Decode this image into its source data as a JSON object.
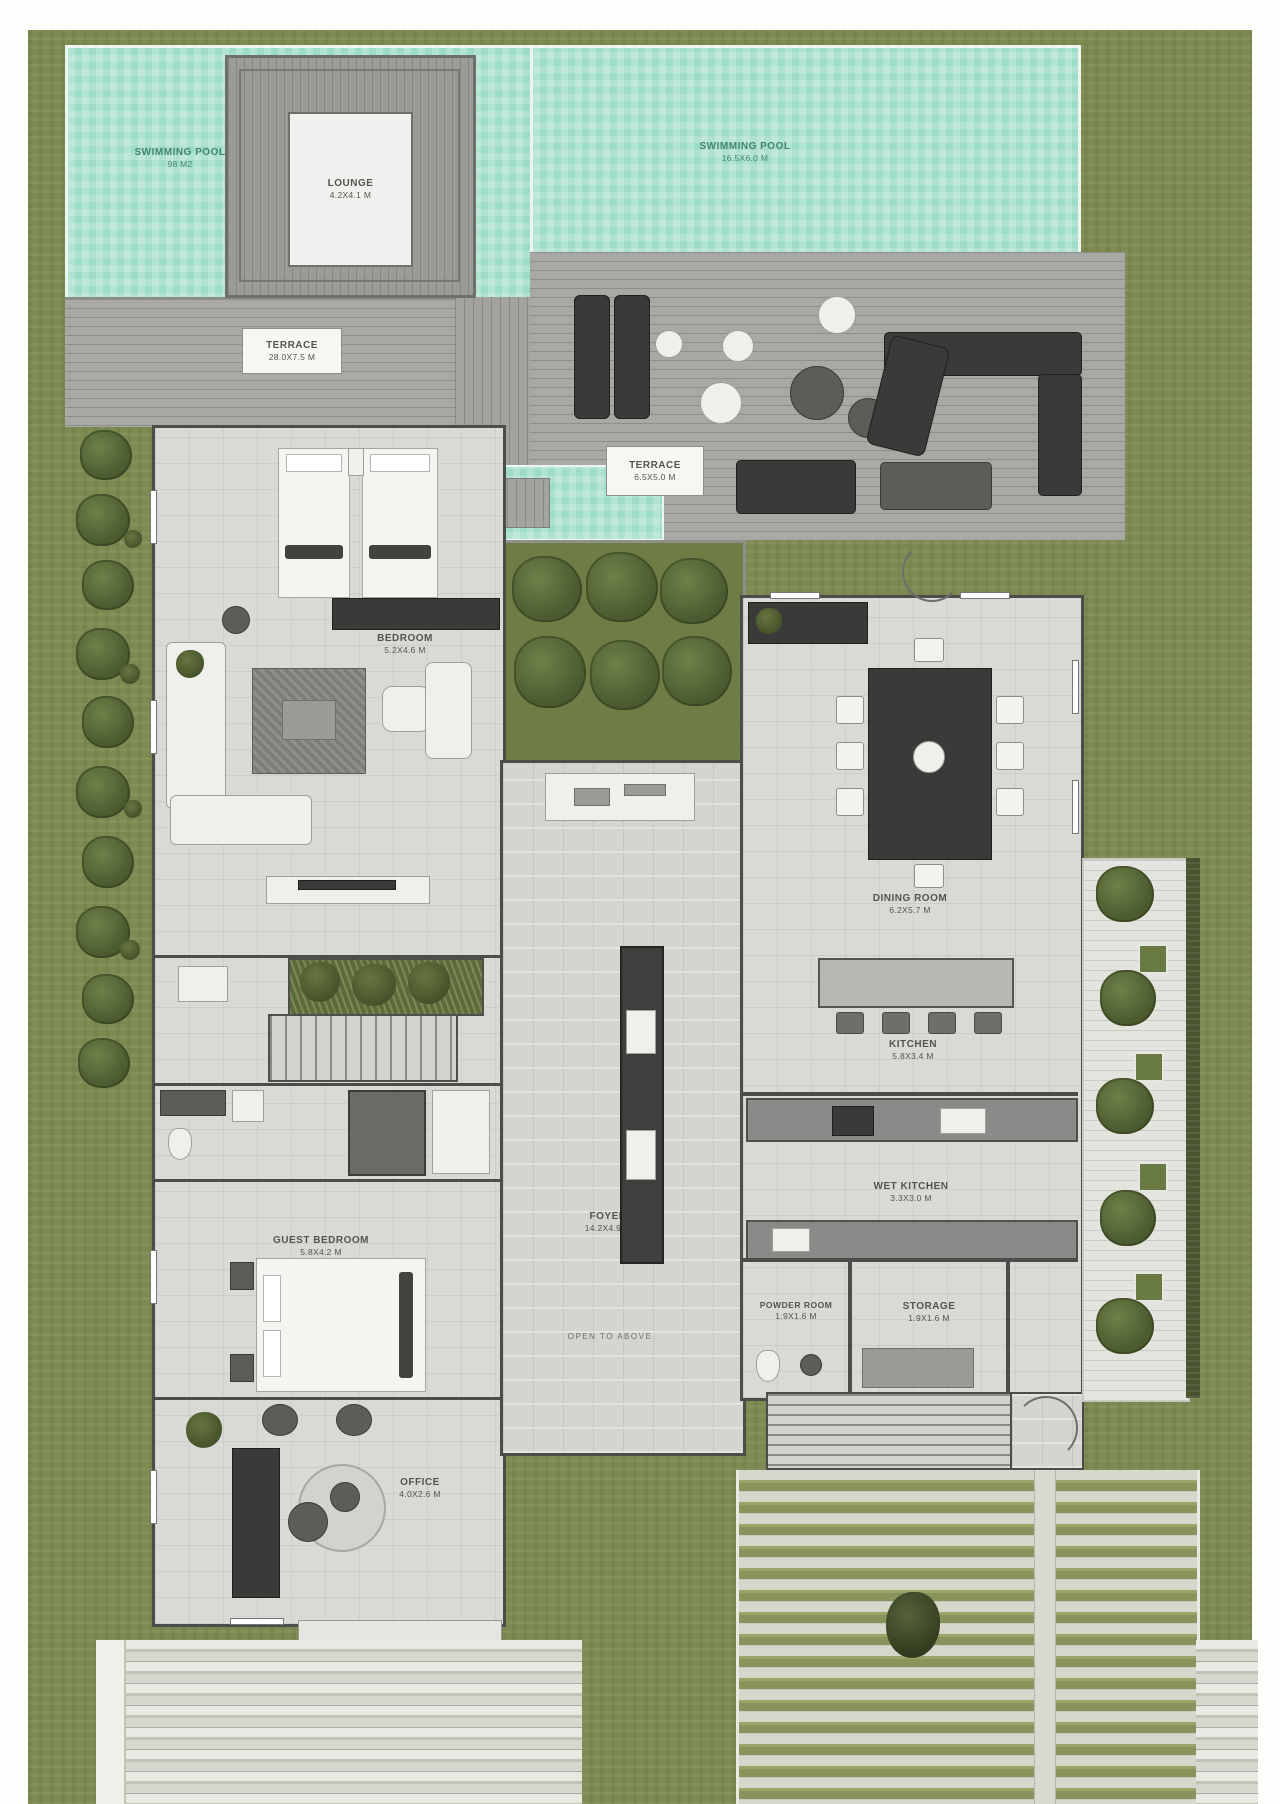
{
  "plan": {
    "pool_left": {
      "label": "SWIMMING POOL",
      "dims": "98 m2"
    },
    "pool_right": {
      "label": "SWIMMING POOL",
      "dims": "16.5x6.0 m"
    },
    "lounge": {
      "label": "LOUNGE",
      "dims": "4.2x4.1 m"
    },
    "terrace_left": {
      "label": "TERRACE",
      "dims": "28.0x7.5 m"
    },
    "terrace_right": {
      "label": "TERRACE",
      "dims": "6.5x5.0 m"
    },
    "bedroom": {
      "label": "BEDROOM",
      "dims": "5.2x4.6 m"
    },
    "dining_room": {
      "label": "DINING ROOM",
      "dims": "6.2x5.7 m"
    },
    "kitchen": {
      "label": "KITCHEN",
      "dims": "5.8x3.4 m"
    },
    "wet_kitchen": {
      "label": "WET KITCHEN",
      "dims": "3.3x3.0 m"
    },
    "foyer": {
      "label": "FOYER",
      "dims": "14.2x4.9 m"
    },
    "foyer_note": "OPEN TO ABOVE",
    "guest_bedroom": {
      "label": "GUEST BEDROOM",
      "dims": "5.8x4.2 m"
    },
    "office": {
      "label": "OFFICE",
      "dims": "4.0x2.6 m"
    },
    "powder_room": {
      "label": "POWDER ROOM",
      "dims": "1.9x1.6 m"
    },
    "storage": {
      "label": "STORAGE",
      "dims": "1.9x1.6 m"
    }
  },
  "colors": {
    "grass": "#7d8b52",
    "pool_water": "#9ddcc6",
    "deck": "#a8a8a5",
    "interior_floor": "#d9d9d5",
    "wall": "#4c4c4a",
    "tree": "#4e5d31",
    "label_text": "#55554f",
    "pool_label_text": "#47836f"
  }
}
